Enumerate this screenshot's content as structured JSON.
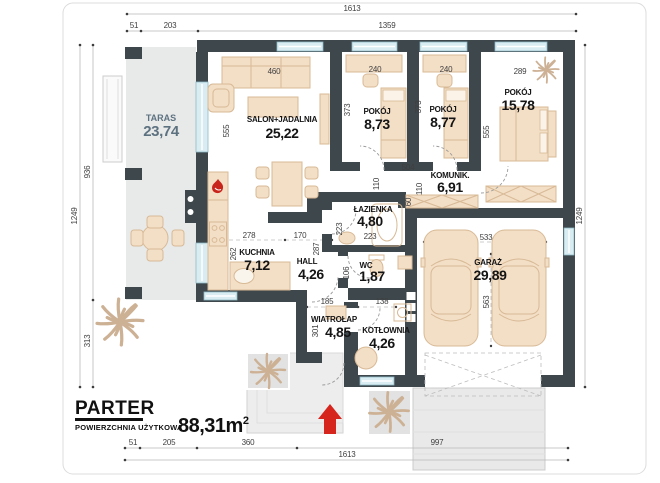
{
  "title": {
    "floor": "PARTER",
    "area_label": "POWIERZCHNIA UŻYTKOWA",
    "area_value": "88,31m",
    "area_sup": "2"
  },
  "rooms": {
    "taras": {
      "name": "TARAS",
      "area": "23,74"
    },
    "salon": {
      "name": "SALON+JADALNIA",
      "area": "25,22"
    },
    "pokoj1": {
      "name": "POKÓJ",
      "area": "8,73"
    },
    "pokoj2": {
      "name": "POKÓJ",
      "area": "8,77"
    },
    "pokoj3": {
      "name": "POKÓJ",
      "area": "15,78"
    },
    "komunik": {
      "name": "KOMUNIK.",
      "area": "6,91"
    },
    "lazienka": {
      "name": "ŁAZIENKA",
      "area": "4,80"
    },
    "kuchnia": {
      "name": "KUCHNIA",
      "area": "7,12"
    },
    "hall": {
      "name": "HALL",
      "area": "4,26"
    },
    "wc": {
      "name": "WC",
      "area": "1,87"
    },
    "wiatrolap": {
      "name": "WIATROŁAP",
      "area": "4,85"
    },
    "kotlownia": {
      "name": "KOTŁOWNIA",
      "area": "4,26"
    },
    "garaz": {
      "name": "GARAŻ",
      "area": "29,89"
    }
  },
  "dims": {
    "top_total": "1613",
    "top_a": "51",
    "top_b": "203",
    "top_c": "1359",
    "bottom_a": "51",
    "bottom_b": "205",
    "bottom_c": "360",
    "bottom_d": "997",
    "bottom_total": "1613",
    "left_outer": "1249",
    "left_upper": "936",
    "left_lower": "313",
    "right_outer": "1249",
    "sofa": "460",
    "salon_h": "555",
    "p1_win": "240",
    "p1_h": "373",
    "p2_win": "240",
    "p2_h": "373",
    "p3_win": "289",
    "p3_h": "555",
    "komunik_w": "504",
    "komunik_h1": "110",
    "komunik_h2": "110",
    "wardrobe": "60",
    "laz_v": "223",
    "laz_h": "223",
    "kuch_a": "278",
    "kuch_b": "170",
    "kuch_v": "262",
    "hall_v": "287",
    "wc_v": "106",
    "wiatr_w": "185",
    "kotl_w": "138",
    "wiatr_v": "301",
    "gar_w": "533",
    "gar_h": "563"
  },
  "icons": {
    "entrance-arrow-icon": "▲",
    "fireplace-flame-icon": "🔥",
    "plant-icon": "✳"
  },
  "colors": {
    "wall": "#3e474b",
    "window": "#d9ecf1",
    "furniture": "#f3dec6",
    "furniture_line": "#d8ba96",
    "taras_fill": "#e8e9e9",
    "accent_red": "#d6251d",
    "dim_text": "#3f3f3f",
    "taras_text": "#5d7280"
  }
}
